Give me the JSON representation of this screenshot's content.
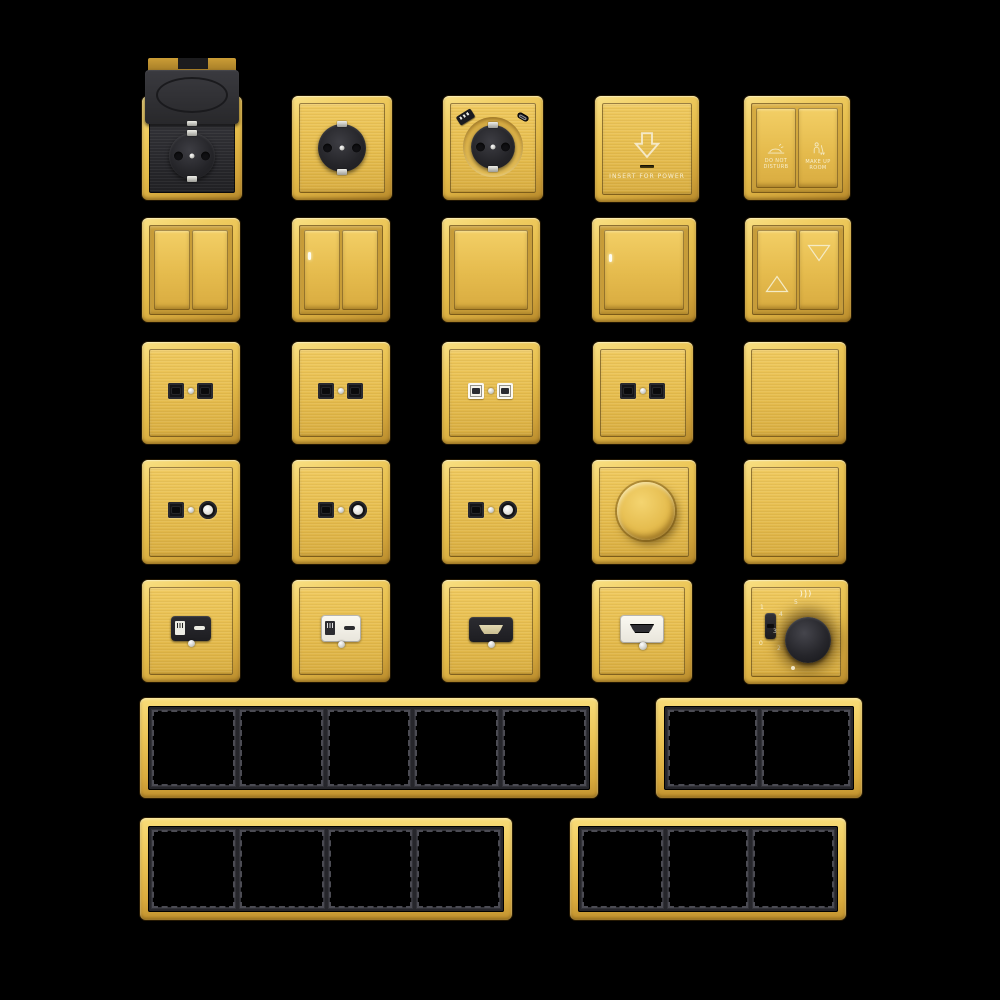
{
  "catalog": {
    "background": "#000000",
    "finish_colors": {
      "gold": "#E6BE4E",
      "gold_light": "#F6D878",
      "gold_dark": "#B2872B",
      "module_black": "#232327",
      "module_white": "#F2EFE8",
      "led_white": "#FDFDF2"
    },
    "key_card_holder": {
      "label": "INSERT FOR POWER"
    },
    "hotel_switch": {
      "left_line1": "DO NOT",
      "left_line2": "DISTURB",
      "right_line1": "MAKE UP",
      "right_line2": "ROOM"
    },
    "fan_controller": {
      "on_label": "1",
      "off_label": "0",
      "speed_labels": [
        "2",
        "3",
        "4",
        "5"
      ]
    },
    "products": [
      "schuko-socket-flip-cover",
      "schuko-socket",
      "schuko-socket-usb",
      "key-card-power-holder",
      "hotel-service-switch",
      "switch-2gang",
      "switch-2gang-indicator",
      "switch-1gang",
      "switch-1gang-indicator",
      "curtain-switch",
      "data-socket-double-black",
      "data-socket-double-black",
      "data-socket-double-white",
      "data-socket-double-black",
      "blank-plate",
      "tv-data-socket-black",
      "tv-data-socket-black",
      "tv-data-socket-black",
      "rotary-dimmer",
      "blank-plate",
      "usb-charger-black",
      "usb-charger-white",
      "hdmi-socket-black",
      "hdmi-socket-white",
      "fan-speed-controller",
      "frame-5-gang",
      "frame-2-gang",
      "frame-4-gang",
      "frame-3-gang"
    ]
  }
}
